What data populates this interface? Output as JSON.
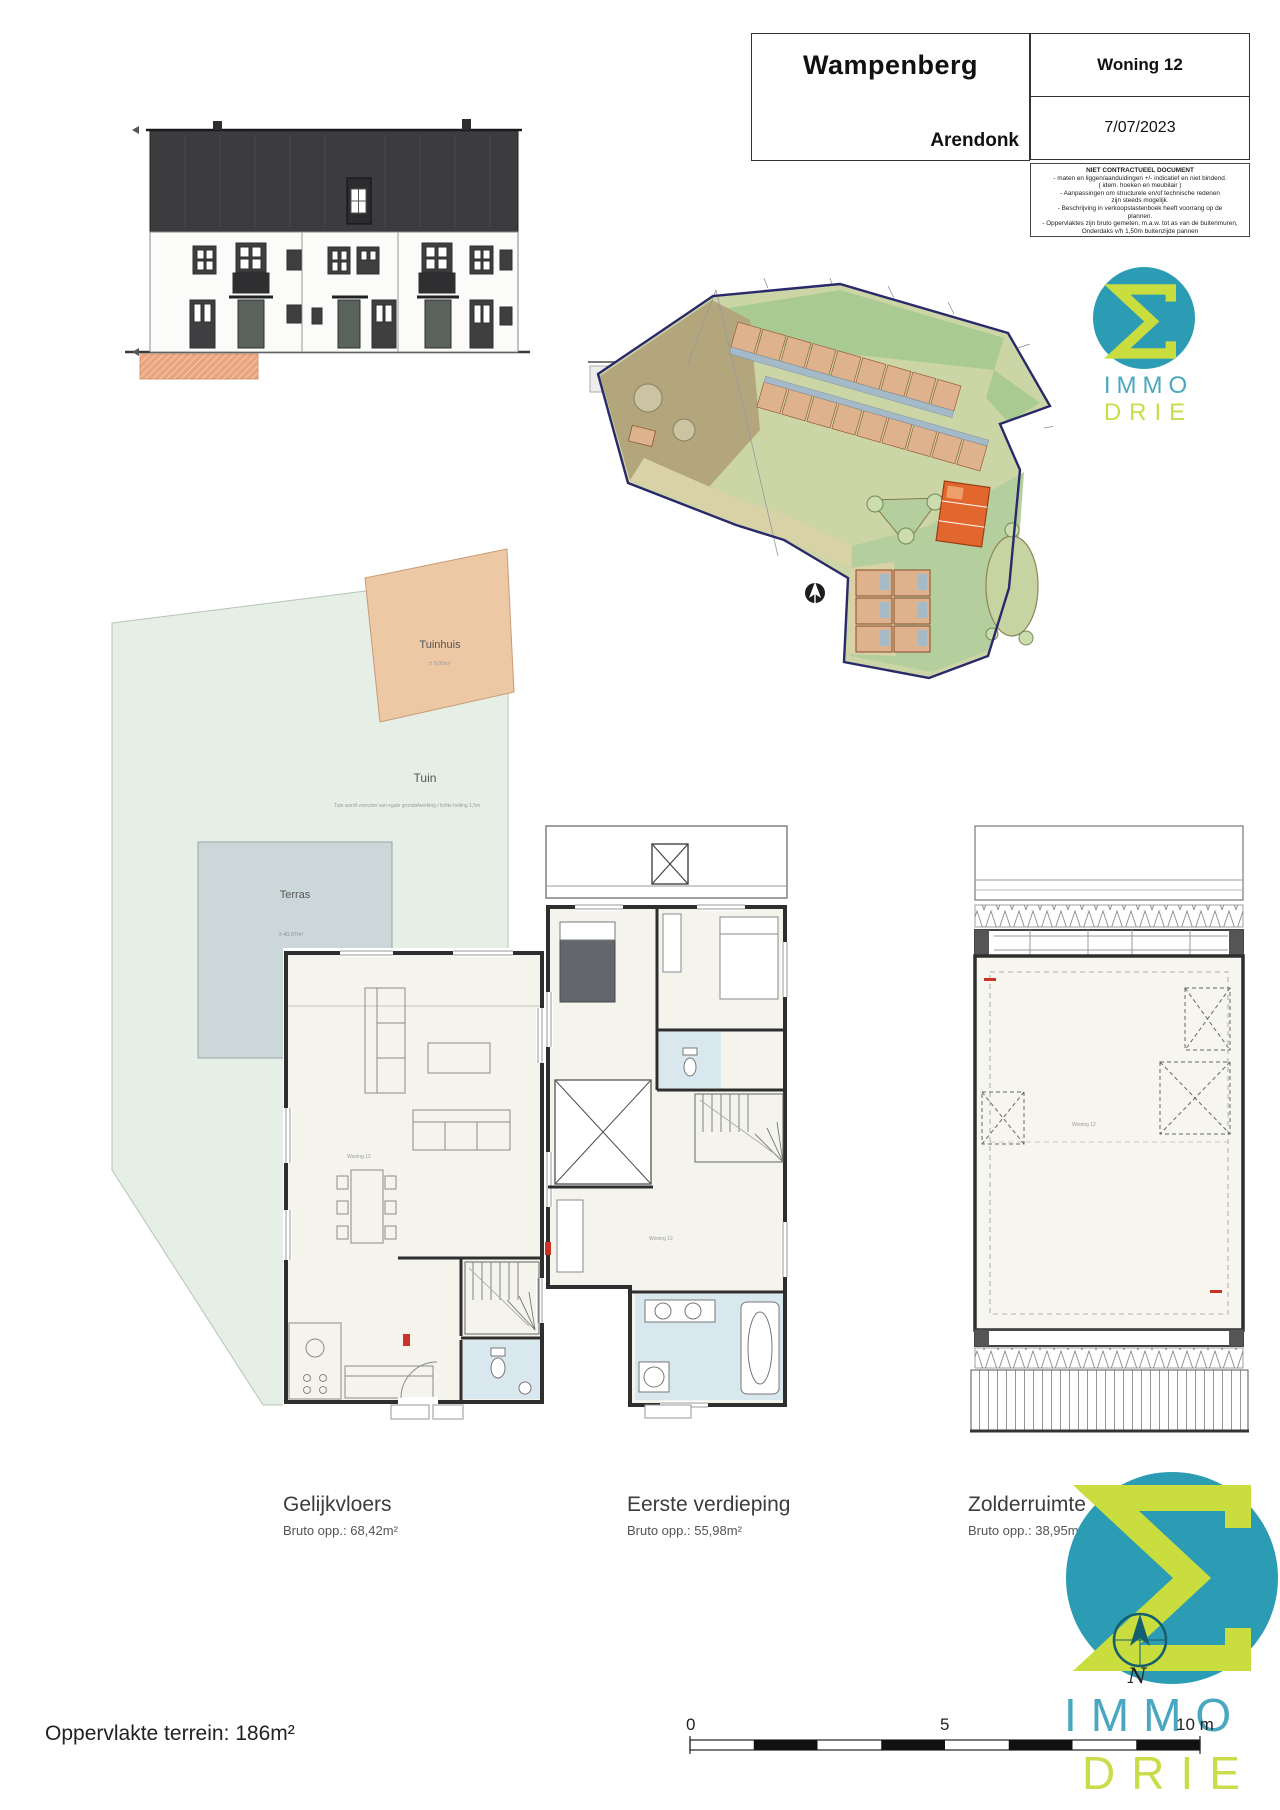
{
  "title_block": {
    "project": "Wampenberg",
    "municipality": "Arendonk",
    "unit": "Woning 12",
    "date": "7/07/2023",
    "disclaimer": {
      "title": "NIET CONTRACTUEEL DOCUMENT",
      "lines": [
        "- maten en liggen/aanduidingen +/- indicatief en niet bindend.",
        "( idem. hoeken en meubilair )",
        "- Aanpassingen om structurele en/of technische redenen",
        "zijn steeds mogelijk.",
        "- Beschrijving in verkoopslastenboek heeft voorrang op de",
        "plannen.",
        "- Oppervlaktes zijn bruto gemeten, m.a.w. tot as van de buitenmuren,",
        "Onderdaks v/h 1,50m buitenzijde pannen"
      ]
    }
  },
  "brand": {
    "name_top": "IMMO",
    "name_bottom": "DRIE",
    "teal": "#2b9cb3",
    "lime": "#c9dd3f",
    "compass_label": "N"
  },
  "garden_plan": {
    "tuinhuis_label": "Tuinhuis",
    "tuinhuis_area": "± 9,00m²",
    "tuin_label": "Tuin",
    "tuin_note": "Tuin wordt voorzien van egale grondafwerking / lichte helling 1,5m",
    "terras_label": "Terras",
    "terras_area": "± 40,07m²"
  },
  "site_plan": {
    "highlight_color": "#e2672e",
    "boundary_color": "#29296b"
  },
  "plans": {
    "unit_tag": "Woning 12"
  },
  "floors": [
    {
      "title": "Gelijkvloers",
      "area": "Bruto opp.: 68,42m²"
    },
    {
      "title": "Eerste verdieping",
      "area": "Bruto opp.: 55,98m²"
    },
    {
      "title": "Zolderruimte",
      "area": "Bruto opp.: 38,95m²"
    }
  ],
  "scale_bar": {
    "tick_0": "0",
    "tick_5": "5",
    "tick_10": "10 m"
  },
  "footer": {
    "site_area": "Oppervlakte terrein: 186m²"
  }
}
